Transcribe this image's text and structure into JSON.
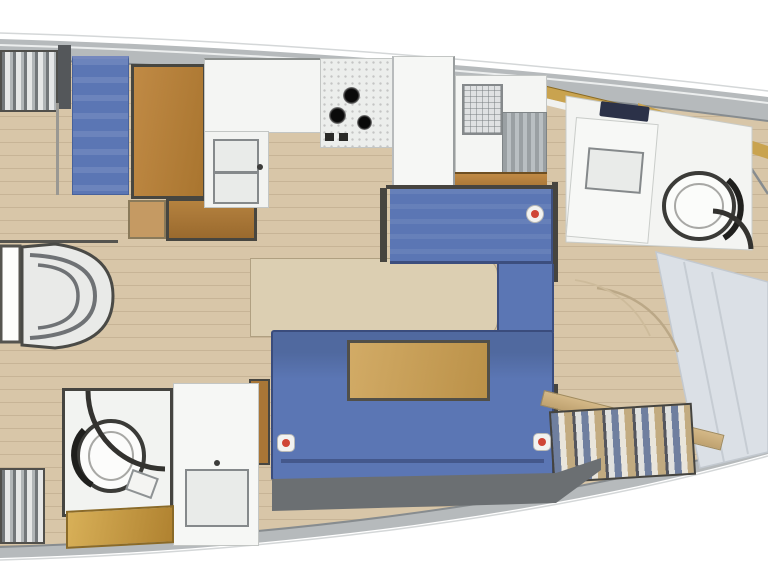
{
  "app": {
    "type": "yacht-interior-floor-plan",
    "view": "top-down",
    "orientation": "bow-right",
    "visible_text": ""
  },
  "palette": {
    "exterior": "#ffffff",
    "hull_band": "#b6babc",
    "hull_line": "#878c8f",
    "floor": "#d8c6a8",
    "floor_line": "#a98f66",
    "wall": "#46443f",
    "blue": "#5b76b4",
    "blue_dark": "#3c4e7e",
    "wood": "#b5823f",
    "table_wood": "#c8a25c",
    "gold_trim": "#c9a34f",
    "unit_white": "#f3f4f2",
    "unit_gray": "#9aa0a3",
    "bed_gray": "#dbe0e6",
    "bench_tan": "#c9ae85",
    "plinth_gray": "#6b6f72",
    "marker_red": "#cf4536"
  },
  "rooms": [
    {
      "id": "companionway-steps",
      "name": "companionway steps"
    },
    {
      "id": "nav-station",
      "name": "chart table with blue seat"
    },
    {
      "id": "galley",
      "name": "galley with stove, sinks and fridge"
    },
    {
      "id": "dinette",
      "name": "blue dinette settee with chaise"
    },
    {
      "id": "saloon-sofa",
      "name": "blue saloon sofa with wood table"
    },
    {
      "id": "aft-head",
      "name": "aft head with toilet and vanity"
    },
    {
      "id": "forward-head",
      "name": "forward head with toilet and vanity"
    },
    {
      "id": "forward-cabin",
      "name": "forward cabin berth with bench"
    }
  ],
  "markers": {
    "count": 3,
    "style": "white badge with red dot"
  }
}
